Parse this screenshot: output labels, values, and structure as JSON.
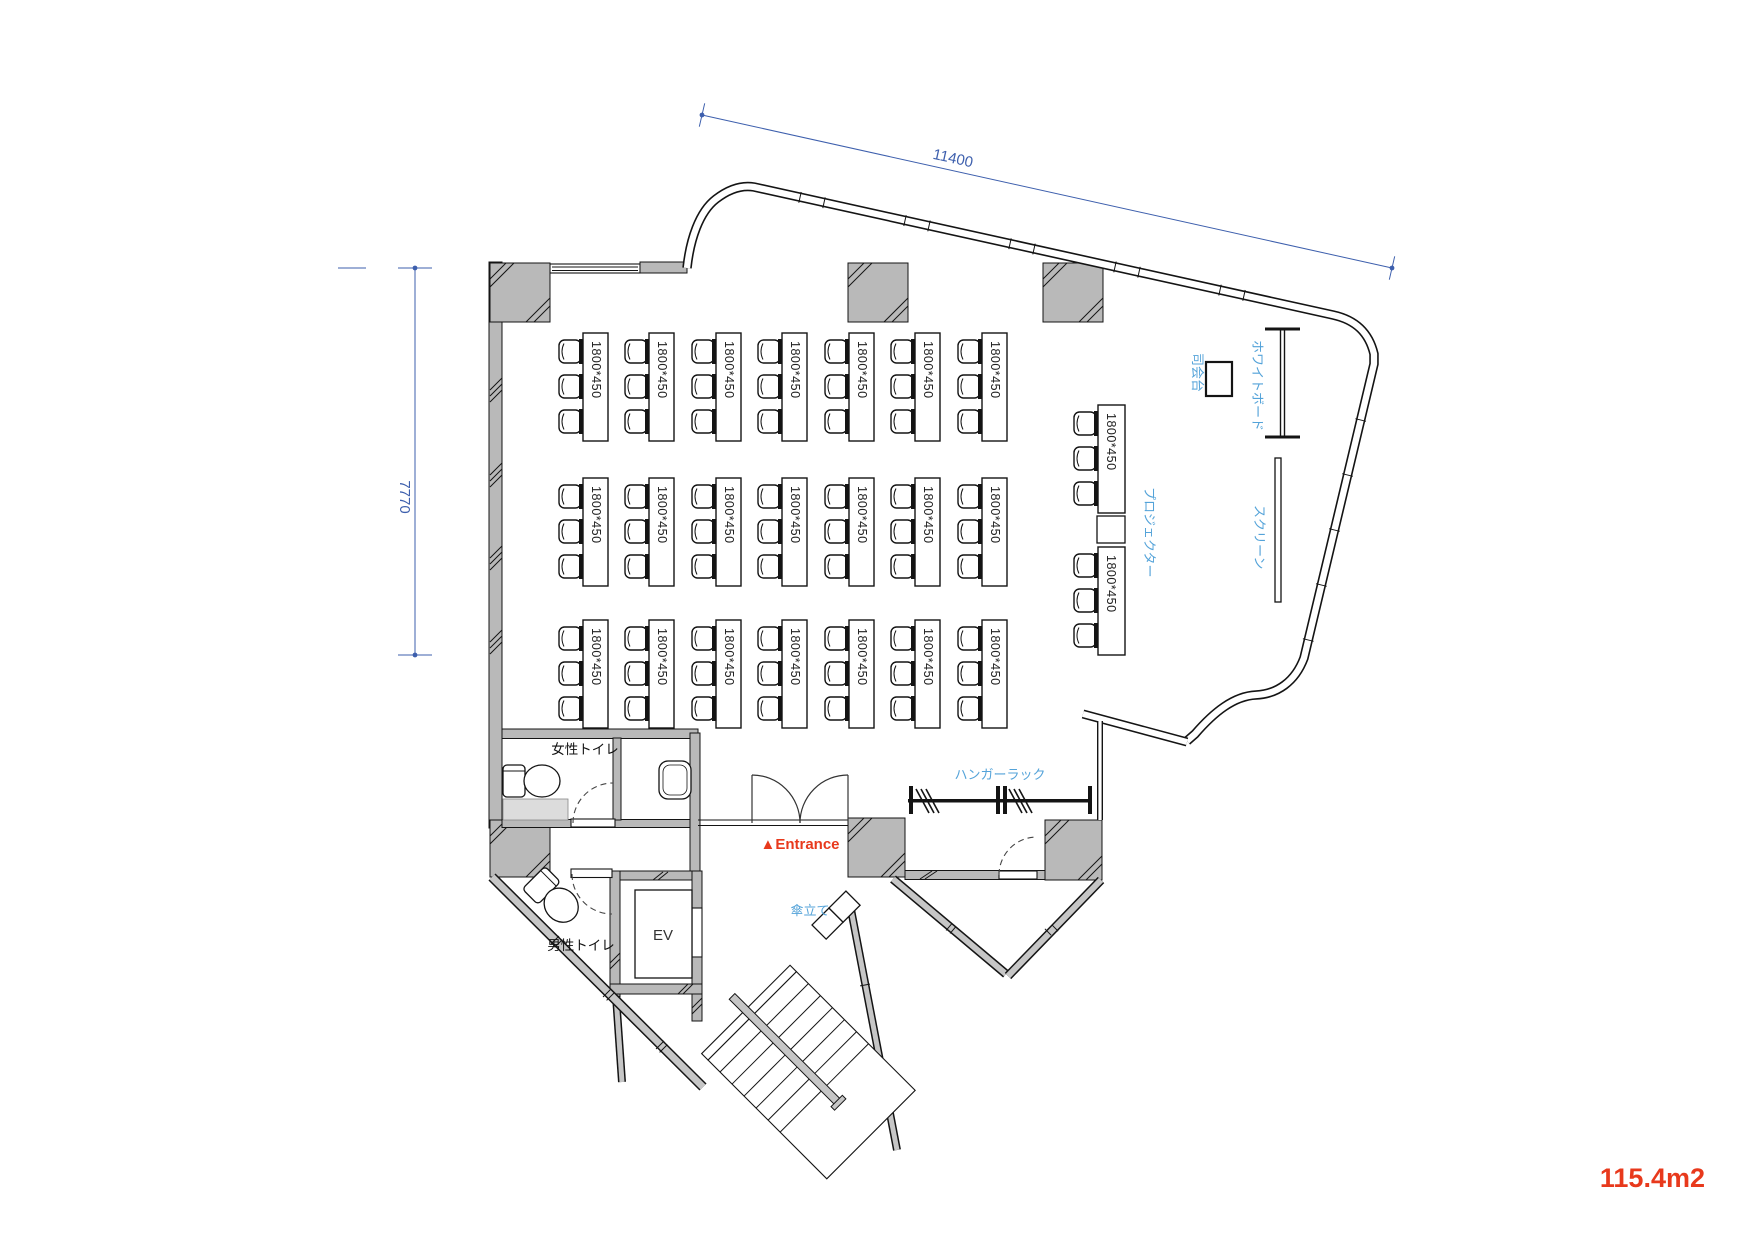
{
  "meta": {
    "area_label": "115.4m2"
  },
  "dimensions": {
    "top": "11400",
    "left": "7770"
  },
  "labels": {
    "mc_stand": "司会台",
    "whiteboard": "ホワイトボード",
    "screen": "スクリーン",
    "projector": "プロジェクター",
    "hanger_rack": "ハンガーラック",
    "womens_toilet": "女性トイレ",
    "mens_toilet": "男性トイレ",
    "elevator": "EV",
    "umbrella_stand": "傘立て",
    "entrance": "▲Entrance"
  },
  "colors": {
    "dim_blue": "#3d5fad",
    "label_blue": "#54a3d9",
    "accent_red": "#e8391c",
    "wall_gray": "#b9b9b9",
    "wall_light": "#c6c6c6",
    "block_gray": "#dcdcdc",
    "line": "#141414"
  },
  "desks": {
    "label": "1800*450",
    "grid": {
      "col_x": [
        583,
        649,
        716,
        782,
        849,
        915,
        982
      ],
      "row_y": [
        333,
        478,
        620
      ],
      "table_w": 25,
      "table_h": 108
    },
    "right_column": {
      "x": 1098,
      "ys": [
        405,
        547
      ],
      "table_w": 27,
      "table_h": 108
    },
    "chair": {
      "offsets": [
        7,
        42,
        77
      ],
      "w": 22,
      "h": 23
    },
    "desk_count": 23,
    "seats_per_desk": 3
  }
}
